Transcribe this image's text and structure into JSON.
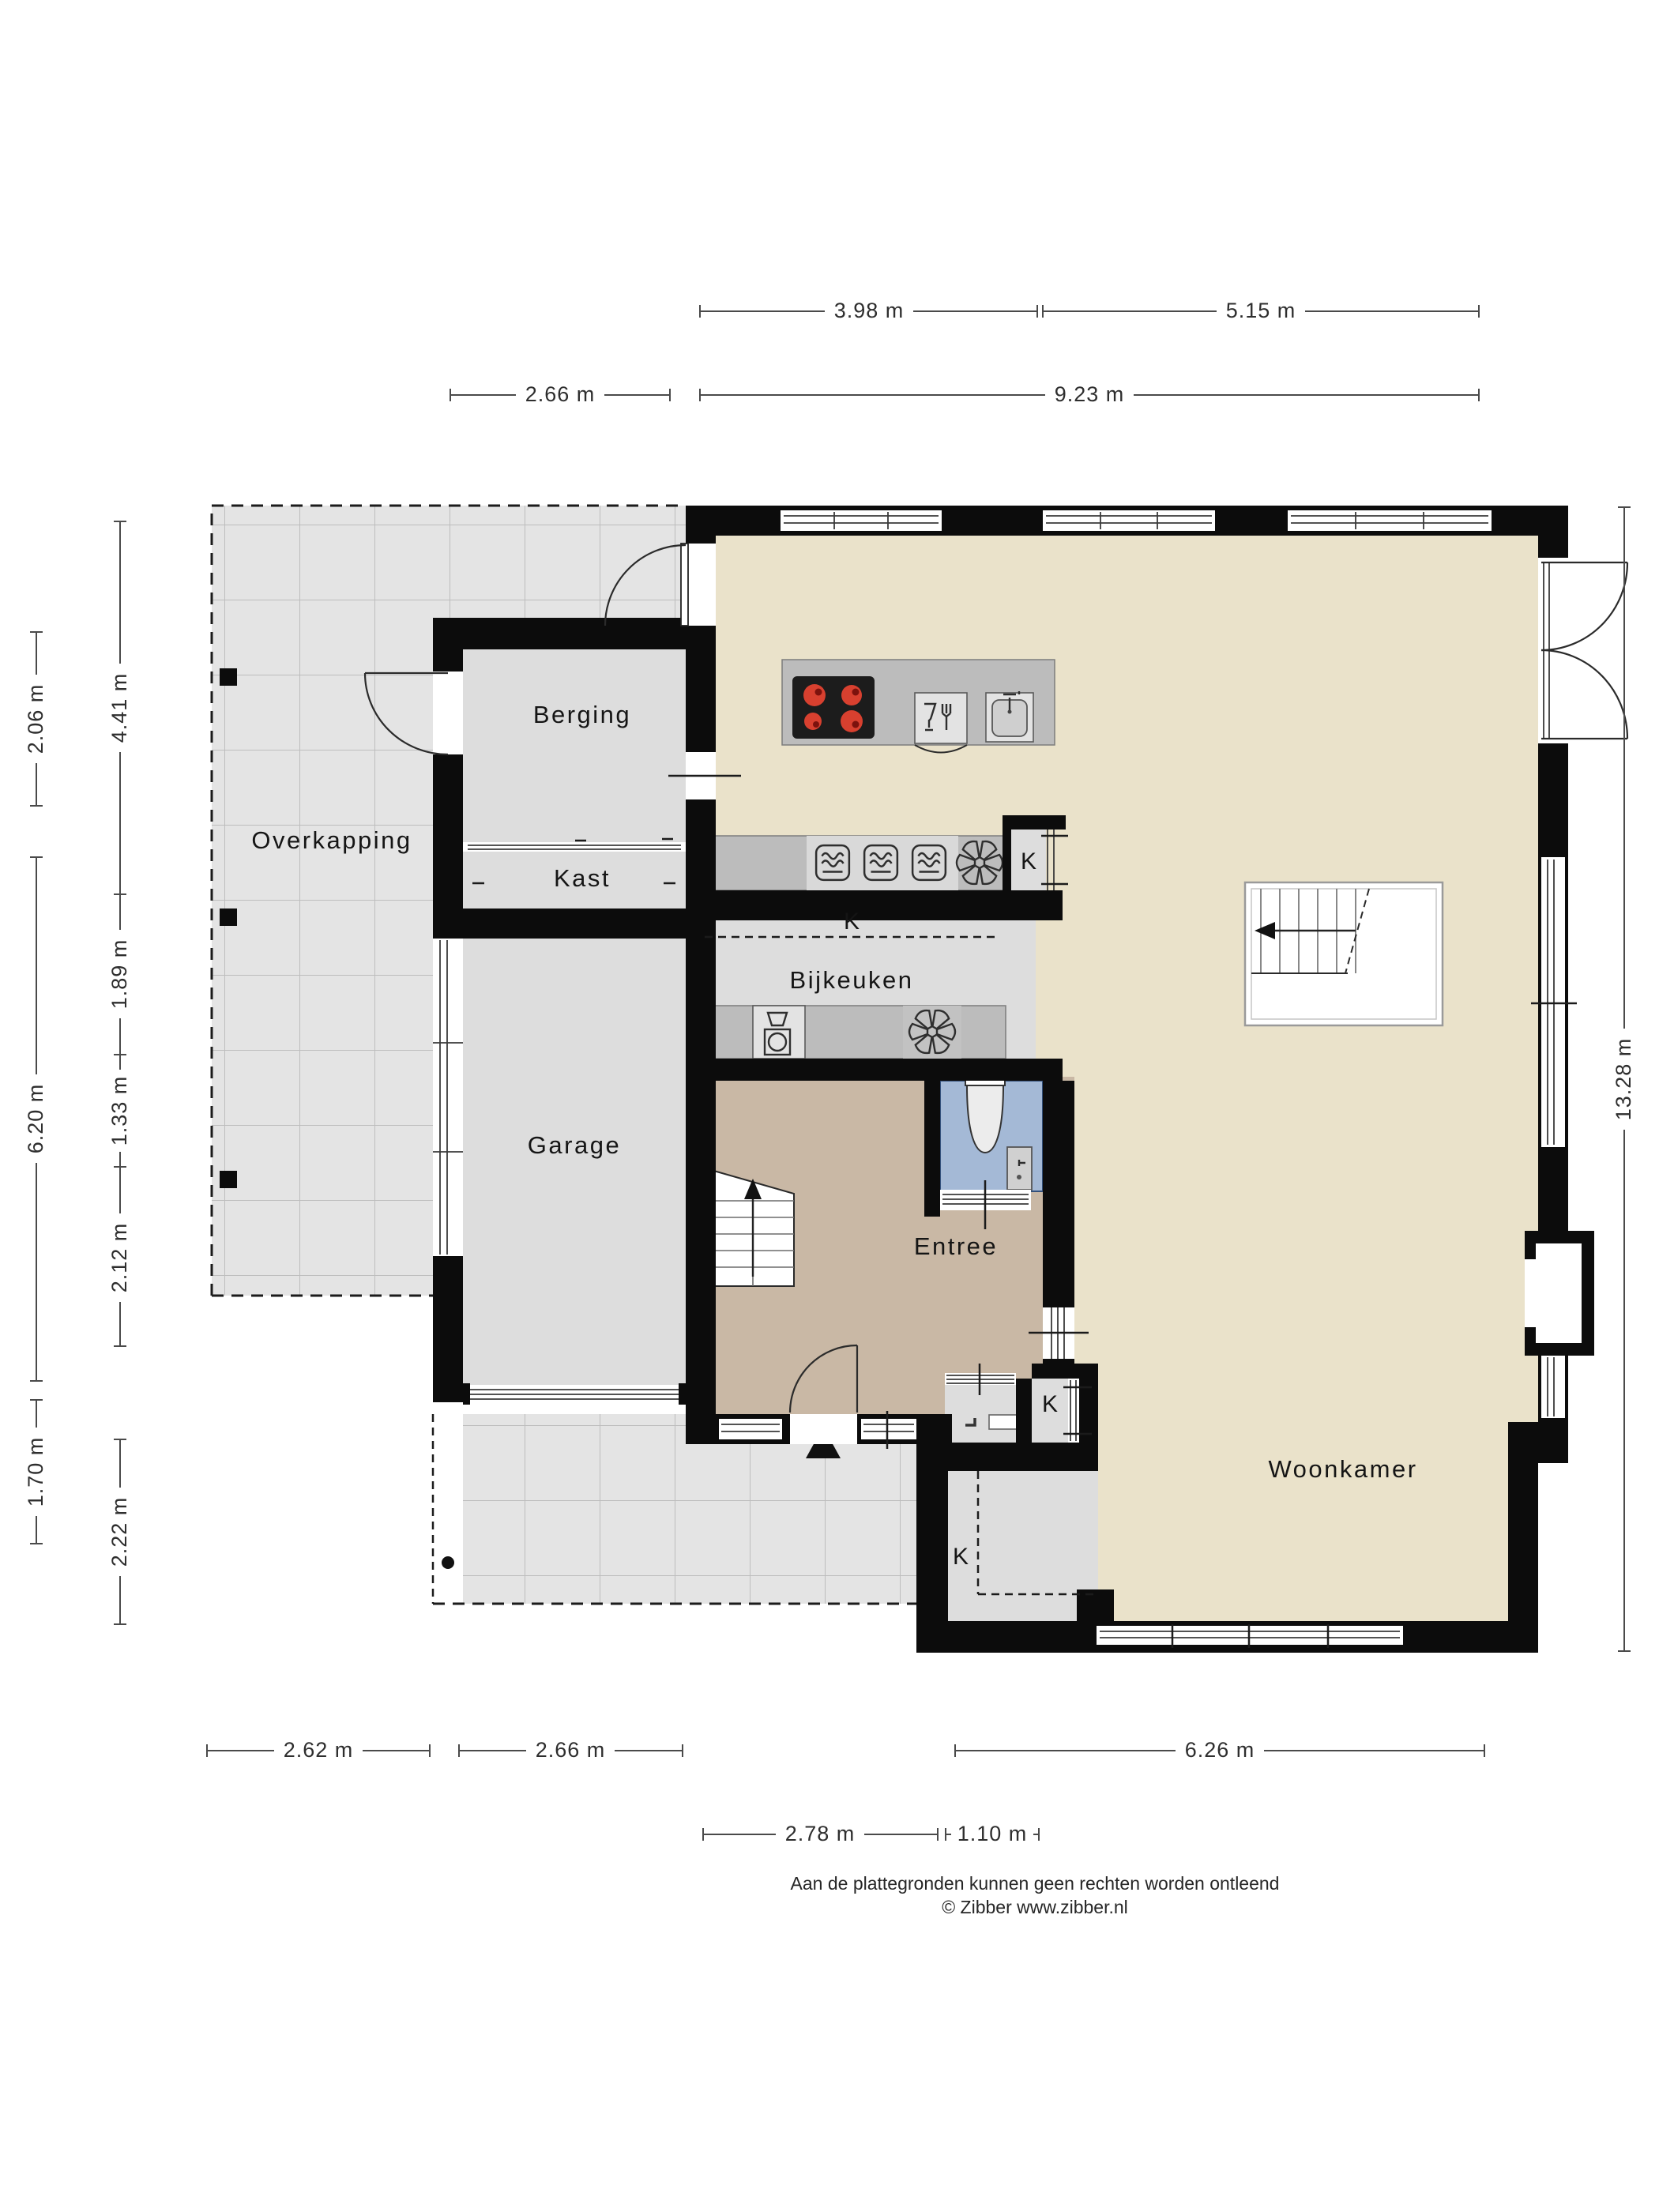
{
  "rooms": {
    "overkapping": "Overkapping",
    "berging": "Berging",
    "kast": "Kast",
    "garage": "Garage",
    "bijkeuken": "Bijkeuken",
    "entree": "Entree",
    "woonkamer": "Woonkamer"
  },
  "closets": {
    "kitchen": "K",
    "bijkeuken": "K",
    "hall": "K",
    "living": "K"
  },
  "dimensions": {
    "top_row1": [
      "3.98 m",
      "5.15 m"
    ],
    "top_row2": [
      "2.66 m",
      "9.23 m"
    ],
    "left_outer": [
      "2.06 m",
      "6.20 m",
      "1.70 m"
    ],
    "left_inner": [
      "4.41 m",
      "1.89 m",
      "1.33 m",
      "2.12 m",
      "2.22 m"
    ],
    "right": [
      "13.28 m"
    ],
    "bottom_row1": [
      "2.62 m",
      "2.66 m",
      "6.26 m"
    ],
    "bottom_row2": [
      "2.78 m",
      "1.10 m"
    ]
  },
  "footer": {
    "line1": "Aan de plattegronden kunnen geen rechten worden ontleend",
    "line2": "© Zibber www.zibber.nl"
  },
  "icons": {
    "hob": "cooktop-icon",
    "dishwasher": "dishwasher-icon",
    "sink": "sink-icon",
    "oven": "oven-icon",
    "fan": "ventilation-fan-icon",
    "washer": "washing-machine-icon",
    "toilet": "toilet-icon",
    "stairs": "stairs-icon",
    "entrance": "entrance-arrow-icon"
  },
  "colors": {
    "wall": "#0c0c0c",
    "floor_main": "#eae2ca",
    "floor_entree": "#c9b8a5",
    "floor_gray": "#dddddd",
    "floor_toilet": "#a4b9d6",
    "tile": "#e4e4e4",
    "tile_line": "#bdbdbd",
    "counter": "#bcbcbc",
    "counter_light": "#d9d9d9",
    "appliance": "#e3e3e3",
    "hob": "#1c1c1c",
    "burner": "#d8402f",
    "burner_dark": "#7c120d",
    "dim": "#4a4a4a"
  }
}
